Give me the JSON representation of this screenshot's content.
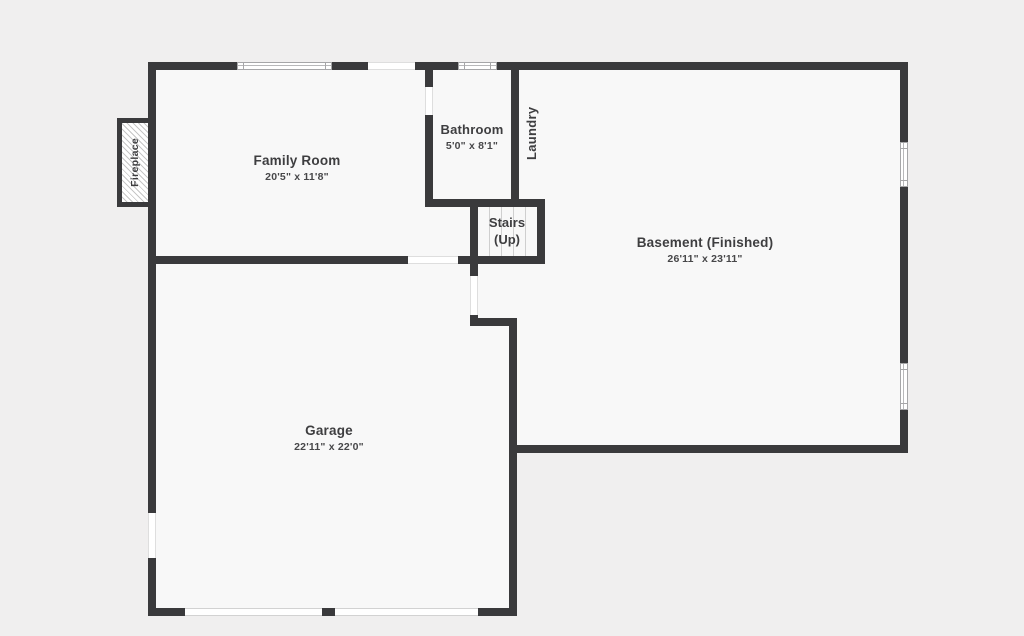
{
  "title": "Basement floor plan",
  "colors": {
    "bg": "#f0efef",
    "floor": "#f8f8f8",
    "wall": "#3a3a3c",
    "text": "#3e3e40",
    "dim": "#474749"
  },
  "rooms": {
    "family_room": {
      "name": "Family Room",
      "dims": "20'5\" x 11'8\""
    },
    "bathroom": {
      "name": "Bathroom",
      "dims": "5'0\" x 8'1\""
    },
    "laundry": {
      "name": "Laundry"
    },
    "stairs": {
      "line1": "Stairs",
      "line2": "(Up)"
    },
    "basement": {
      "name": "Basement (Finished)",
      "dims": "26'11\" x 23'11\""
    },
    "garage": {
      "name": "Garage",
      "dims": "22'11\" x 22'0\""
    },
    "fireplace": {
      "name": "Fireplace"
    }
  }
}
